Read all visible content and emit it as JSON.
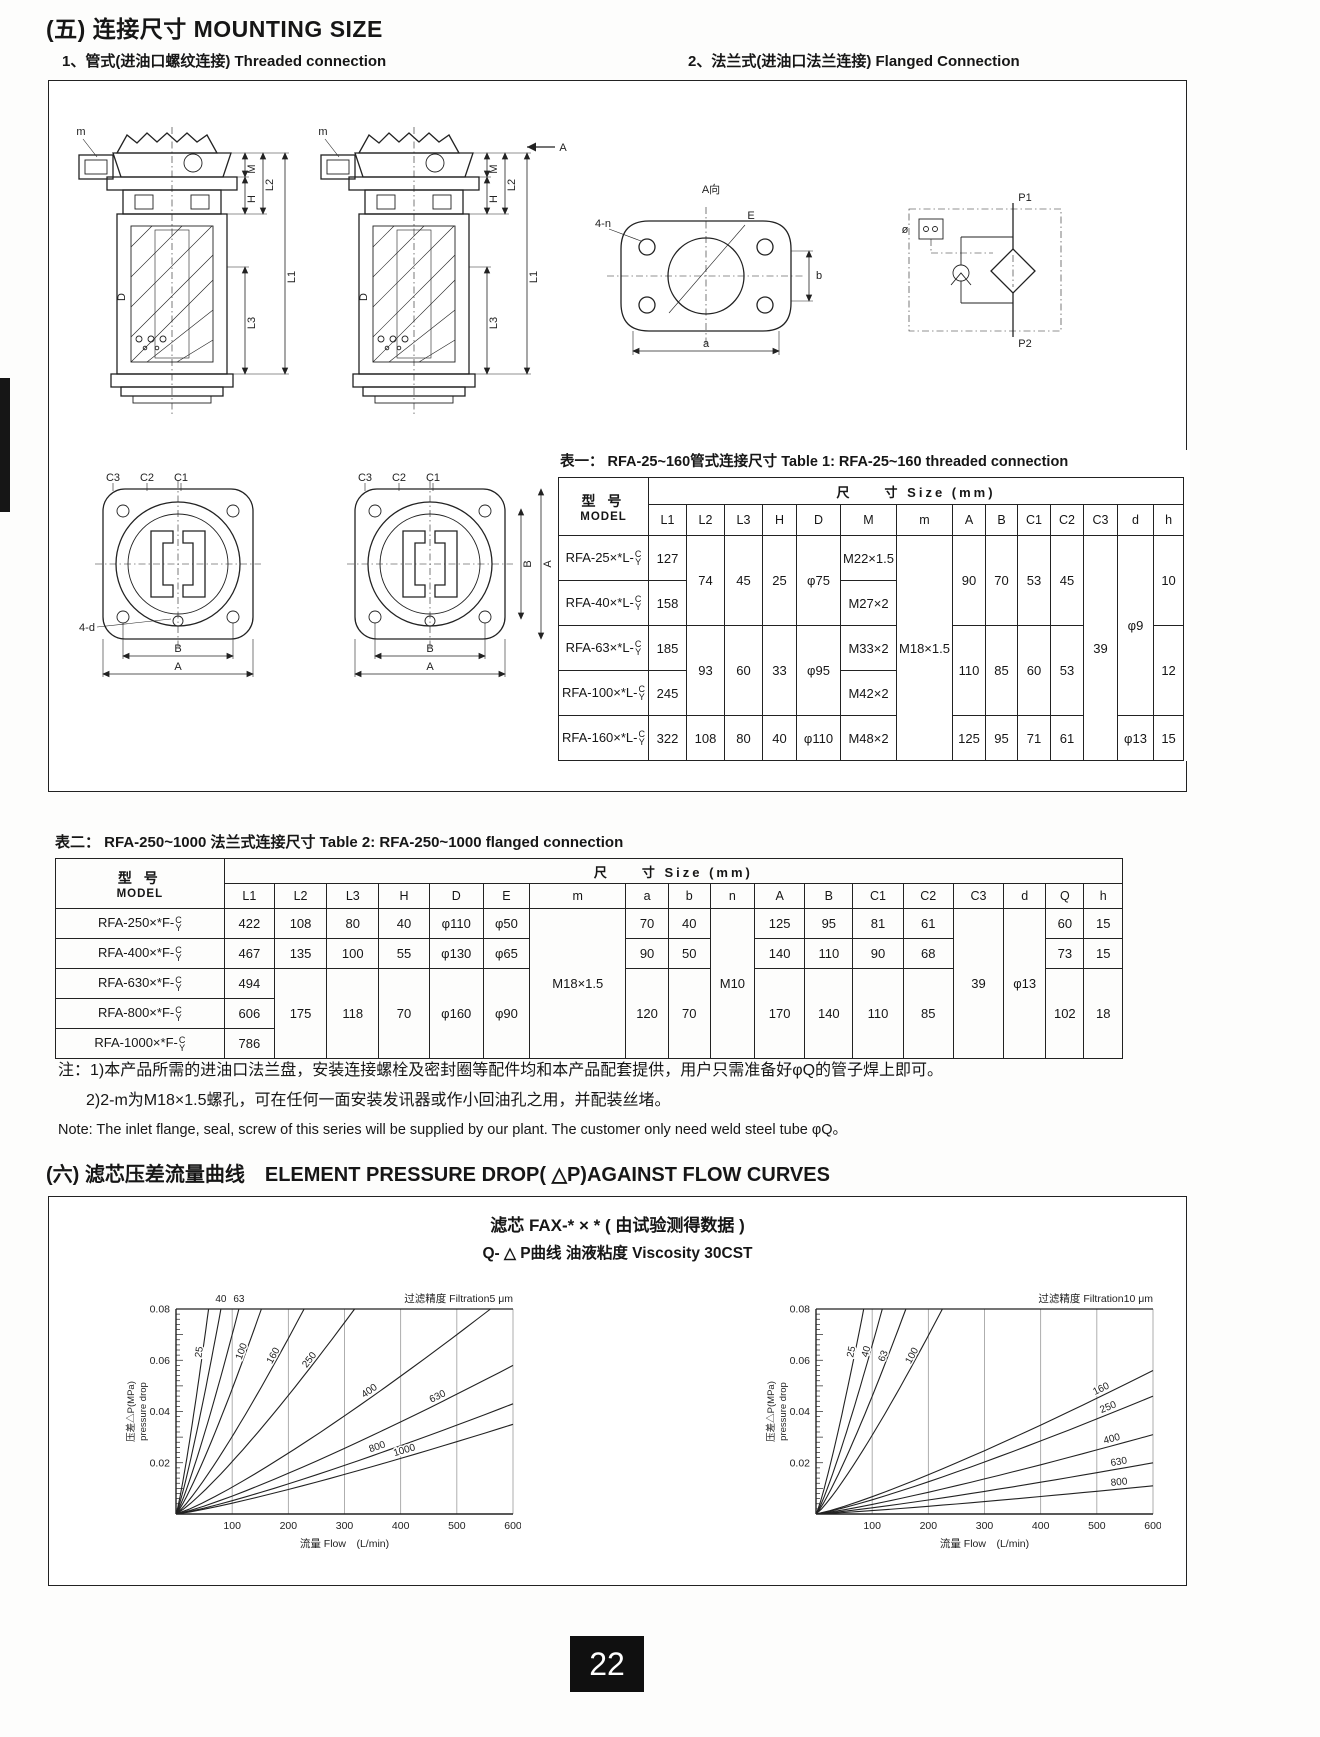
{
  "page_number": "22",
  "header": {
    "section5": "(五) 连接尺寸  MOUNTING SIZE",
    "sub1": "1、管式(进油口螺纹连接)  Threaded connection",
    "sub2": "2、法兰式(进油口法兰连接)  Flanged Connection"
  },
  "section6": "(六) 滤芯压差流量曲线　ELEMENT PRESSURE DROP( △P)AGAINST FLOW CURVES",
  "model_suffix": {
    "top": "C",
    "bot": "Y"
  },
  "diagram": {
    "m": "m",
    "M": "M",
    "H": "H",
    "L1": "L1",
    "L2": "L2",
    "L3": "L3",
    "D": "D",
    "A_arrow": "A",
    "C3": "C3",
    "C2": "C2",
    "C1": "C1",
    "B": "B",
    "A": "A",
    "four_d": "4-d",
    "A_view": "A向",
    "E": "E",
    "four_n": "4-n",
    "a": "a",
    "b": "b",
    "P1": "P1",
    "P2": "P2",
    "phi": "ø"
  },
  "table1": {
    "title_zh": "表一： RFA-25~160管式连接尺寸",
    "title_en": "Table 1: RFA-25~160 threaded connection",
    "model_zh": "型 号",
    "model_en": "MODEL",
    "size_header": "尺　　寸  Size  (mm)",
    "columns": [
      "L1",
      "L2",
      "L3",
      "H",
      "D",
      "M",
      "m",
      "A",
      "B",
      "C1",
      "C2",
      "C3",
      "d",
      "h"
    ],
    "r1": {
      "model": "RFA-25×*L-",
      "L1": "127",
      "M": "M22×1.5"
    },
    "r2": {
      "model": "RFA-40×*L-",
      "L1": "158",
      "M": "M27×2"
    },
    "r3": {
      "model": "RFA-63×*L-",
      "L1": "185",
      "M": "M33×2"
    },
    "r4": {
      "model": "RFA-100×*L-",
      "L1": "245",
      "M": "M42×2"
    },
    "r5": {
      "model": "RFA-160×*L-",
      "L1": "322",
      "L2": "108",
      "L3": "80",
      "H": "40",
      "D": "φ110",
      "M": "M48×2",
      "A": "125",
      "B": "95",
      "C1": "71",
      "C2": "61",
      "d": "φ13",
      "h": "15"
    },
    "g12": {
      "L2": "74",
      "L3": "45",
      "H": "25",
      "D": "φ75",
      "A": "90",
      "B": "70",
      "C1": "53",
      "C2": "45",
      "h": "10"
    },
    "g34": {
      "L2": "93",
      "L3": "60",
      "H": "33",
      "D": "φ95",
      "A": "110",
      "B": "85",
      "C1": "60",
      "C2": "53",
      "h": "12"
    },
    "m": "M18×1.5",
    "C3": "39",
    "d14": "φ9"
  },
  "table2": {
    "title_zh": "表二： RFA-250~1000 法兰式连接尺寸",
    "title_en": "Table 2: RFA-250~1000 flanged  connection",
    "model_zh": "型  号",
    "model_en": "MODEL",
    "size_header": "尺　　寸  Size  (mm)",
    "columns": [
      "L1",
      "L2",
      "L3",
      "H",
      "D",
      "E",
      "m",
      "a",
      "b",
      "n",
      "A",
      "B",
      "C1",
      "C2",
      "C3",
      "d",
      "Q",
      "h"
    ],
    "r1": {
      "model": "RFA-250×*F-",
      "L1": "422",
      "L2": "108",
      "L3": "80",
      "H": "40",
      "D": "φ110",
      "E": "φ50",
      "a": "70",
      "b": "40",
      "A": "125",
      "B": "95",
      "C1": "81",
      "C2": "61",
      "Q": "60",
      "h": "15"
    },
    "r2": {
      "model": "RFA-400×*F-",
      "L1": "467",
      "L2": "135",
      "L3": "100",
      "H": "55",
      "D": "φ130",
      "E": "φ65",
      "a": "90",
      "b": "50",
      "A": "140",
      "B": "110",
      "C1": "90",
      "C2": "68",
      "Q": "73",
      "h": "15"
    },
    "r3": {
      "model": "RFA-630×*F-",
      "L1": "494"
    },
    "r4": {
      "model": "RFA-800×*F-",
      "L1": "606"
    },
    "r5": {
      "model": "RFA-1000×*F-",
      "L1": "786"
    },
    "g345": {
      "L2": "175",
      "L3": "118",
      "H": "70",
      "D": "φ160",
      "E": "φ90",
      "a": "120",
      "b": "70",
      "A": "170",
      "B": "140",
      "C1": "110",
      "C2": "85",
      "Q": "102",
      "h": "18"
    },
    "m": "M18×1.5",
    "n": "M10",
    "C3": "39",
    "d": "φ13"
  },
  "notes": {
    "line1": "注：1)本产品所需的进油口法兰盘，安装连接螺栓及密封圈等配件均和本产品配套提供，用户只需准备好φQ的管子焊上即可。",
    "line2": "2)2-m为M18×1.5螺孔，可在任何一面安装发讯器或作小回油孔之用，并配装丝堵。",
    "line3": "Note: The inlet flange, seal, screw of this series will be supplied by our plant. The customer only need weld steel tube φQ。"
  },
  "chart_data": [
    {
      "type": "line",
      "title": "滤芯 FAX-* × * ( 由试验测得数据 )",
      "subtitle": "Q- △ P曲线 油液粘度 Viscosity 30CST",
      "filtration": "过滤精度 Filtration5 μm",
      "xlabel": "流量 Flow　(L/min)",
      "ylabel": "压差△P(MPa)",
      "ylabel2": "pressure drop",
      "xlim": [
        0,
        600
      ],
      "ylim": [
        0,
        0.08
      ],
      "xticks": [
        100,
        200,
        300,
        400,
        500,
        600
      ],
      "yticks": [
        0.02,
        0.04,
        0.06,
        0.08
      ],
      "grid": "vertical",
      "legend_position": "on-curve",
      "series": [
        {
          "name": "25",
          "end_flow": 58,
          "end_dp": 0.08,
          "label_t": 0.8
        },
        {
          "name": "40",
          "end_flow": 80,
          "end_dp": 0.08,
          "label": "top"
        },
        {
          "name": "63",
          "end_flow": 112,
          "end_dp": 0.08,
          "label": "top"
        },
        {
          "name": "100",
          "end_flow": 152,
          "end_dp": 0.08,
          "label_t": 0.8
        },
        {
          "name": "160",
          "end_flow": 228,
          "end_dp": 0.08,
          "label_t": 0.78
        },
        {
          "name": "250",
          "end_flow": 318,
          "end_dp": 0.08,
          "label_t": 0.76
        },
        {
          "name": "400",
          "end_flow": 560,
          "end_dp": 0.08,
          "label_t": 0.62
        },
        {
          "name": "630",
          "end_flow": 600,
          "end_dp": 0.058,
          "label_t": 0.78
        },
        {
          "name": "800",
          "end_flow": 600,
          "end_dp": 0.043,
          "label_t": 0.6
        },
        {
          "name": "1000",
          "end_flow": 600,
          "end_dp": 0.035,
          "label_t": 0.68
        }
      ]
    },
    {
      "type": "line",
      "title": "滤芯 FAX-* × * ( 由试验测得数据 )",
      "subtitle": "Q- △ P曲线 油液粘度 Viscosity 30CST",
      "filtration": "过滤精度 Filtration10 μm",
      "xlabel": "流量 Flow　(L/min)",
      "ylabel": "压差△P(MPa)",
      "ylabel2": "pressure drop",
      "xlim": [
        0,
        600
      ],
      "ylim": [
        0,
        0.08
      ],
      "xticks": [
        100,
        200,
        300,
        400,
        500,
        600
      ],
      "yticks": [
        0.02,
        0.04,
        0.06,
        0.08
      ],
      "grid": "vertical",
      "legend_position": "on-curve",
      "series": [
        {
          "name": "25",
          "end_flow": 85,
          "end_dp": 0.08,
          "label_t": 0.8
        },
        {
          "name": "40",
          "end_flow": 118,
          "end_dp": 0.08,
          "label_t": 0.8
        },
        {
          "name": "63",
          "end_flow": 160,
          "end_dp": 0.08,
          "label_t": 0.78
        },
        {
          "name": "100",
          "end_flow": 225,
          "end_dp": 0.08,
          "label_t": 0.78
        },
        {
          "name": "160",
          "end_flow": 600,
          "end_dp": 0.056,
          "label_t": 0.85
        },
        {
          "name": "250",
          "end_flow": 600,
          "end_dp": 0.046,
          "label_t": 0.87
        },
        {
          "name": "400",
          "end_flow": 600,
          "end_dp": 0.031,
          "label_t": 0.88
        },
        {
          "name": "630",
          "end_flow": 600,
          "end_dp": 0.02,
          "label_t": 0.9
        },
        {
          "name": "800",
          "end_flow": 600,
          "end_dp": 0.011,
          "label_t": 0.9
        }
      ]
    }
  ]
}
